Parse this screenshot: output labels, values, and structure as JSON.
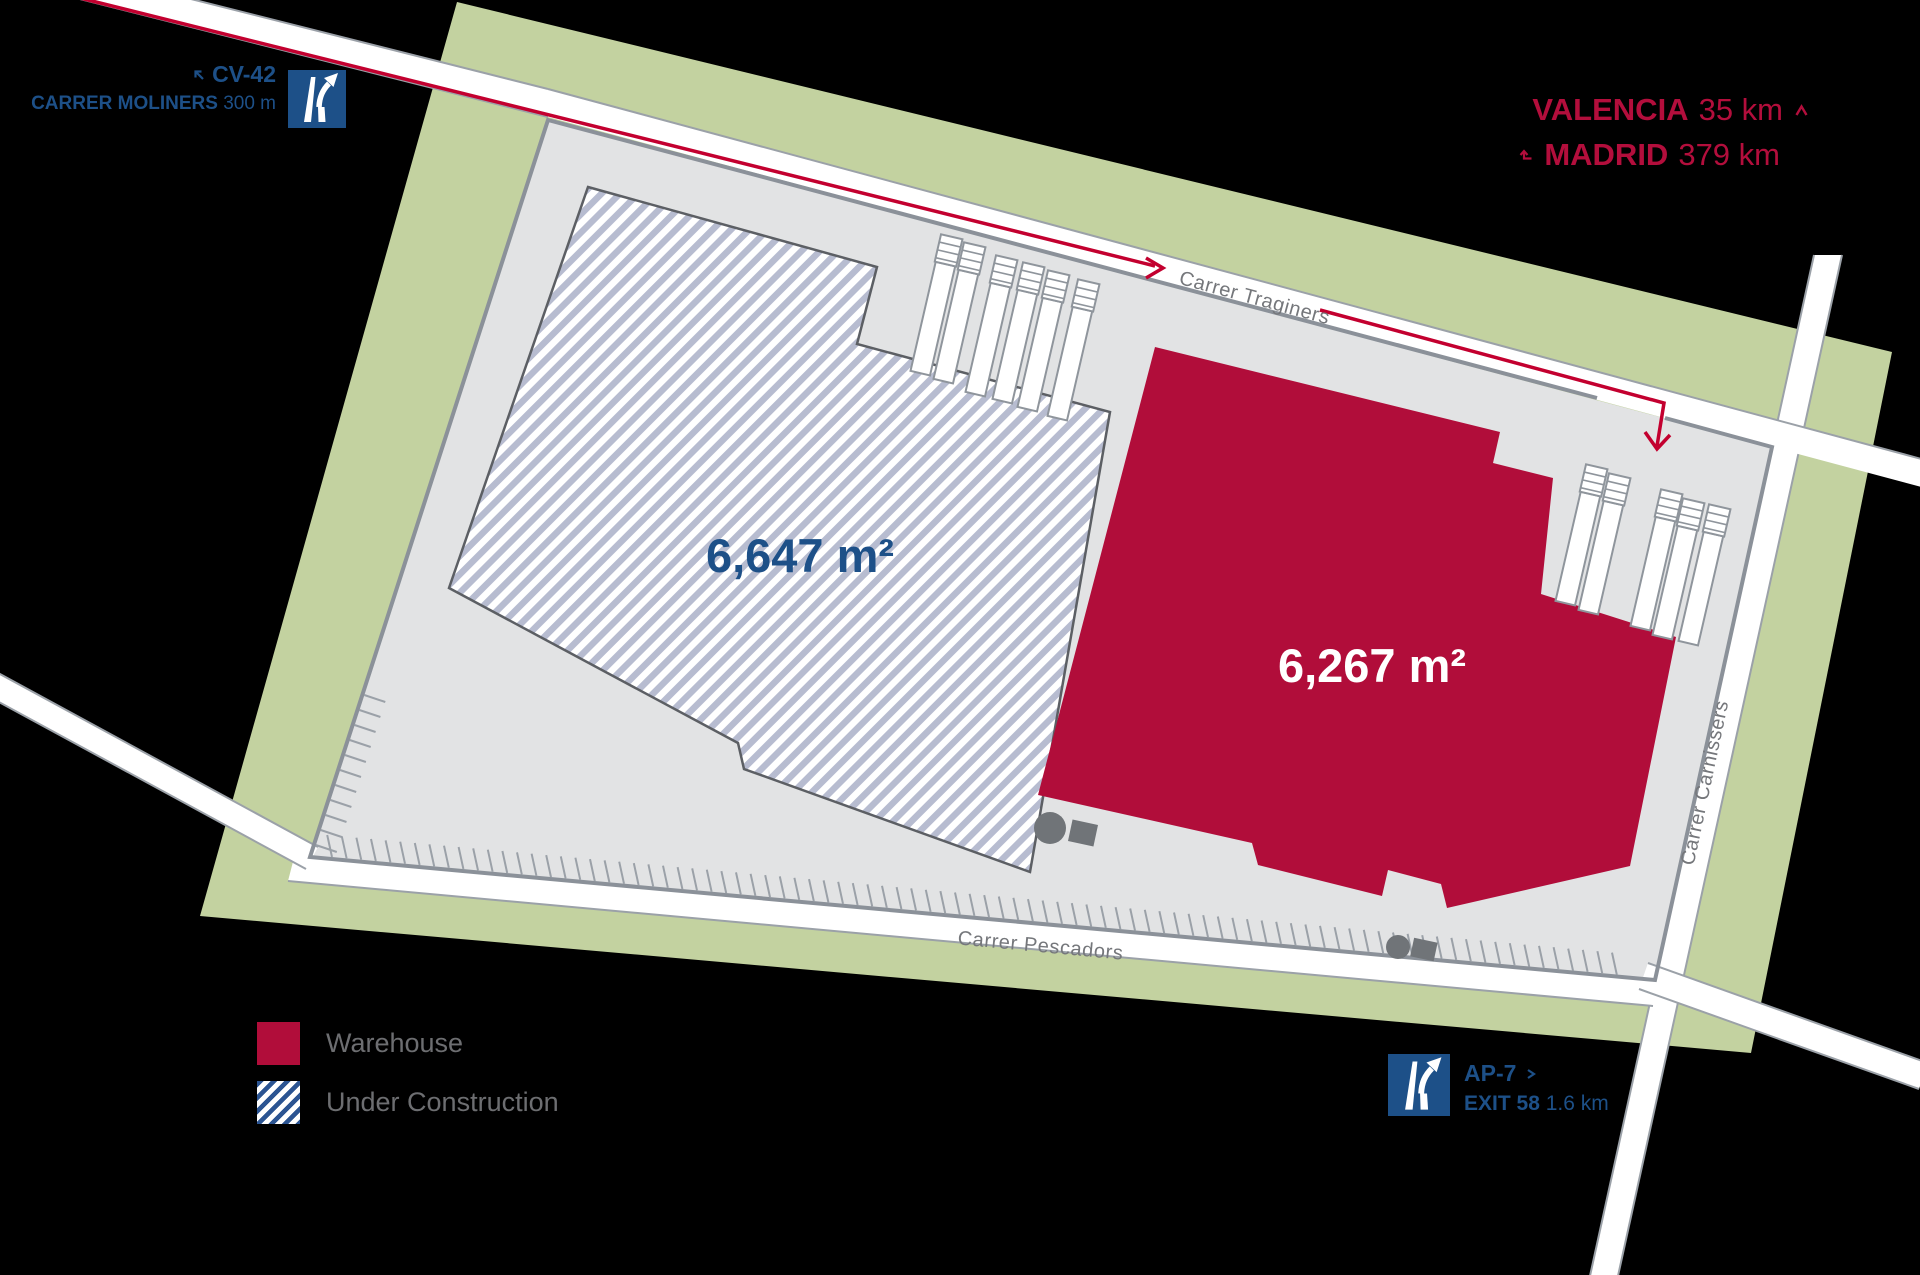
{
  "colors": {
    "green": "#c3d2a0",
    "plot": "#e2e3e4",
    "plot-border": "#8b9199",
    "road-edge": "#9ba1a8",
    "warehouse": "#b10d3a",
    "crimson": "#b30e3c",
    "blue": "#1d5088",
    "uc-stripe": "#b7bcd0",
    "uc-outline": "#5c5f64",
    "legend-hatch": "#2b5492",
    "route": "#c3002f",
    "dock": "#8f959c",
    "object": "#707478",
    "graytext": "#6d6e71",
    "roadtext": "#75777b"
  },
  "access": {
    "cv42": {
      "route": "CV-42",
      "street": "CARRER MOLINERS",
      "distance": "300 m"
    },
    "ap7": {
      "route": "AP-7",
      "exit": "EXIT 58",
      "distance": "1.6 km"
    }
  },
  "cities": {
    "valencia": {
      "name": "VALENCIA",
      "distance": "35 km"
    },
    "madrid": {
      "name": "MADRID",
      "distance": "379 km"
    }
  },
  "roads": {
    "traginers": "Carrer Traginers",
    "carnissers": "Carrer Carnissers",
    "pescadors": "Carrer Pescadors"
  },
  "buildings": {
    "under_construction": {
      "area": "6,647 m²"
    },
    "warehouse": {
      "area": "6,267 m²"
    }
  },
  "legend": [
    {
      "label": "Warehouse"
    },
    {
      "label": "Under Construction"
    }
  ]
}
